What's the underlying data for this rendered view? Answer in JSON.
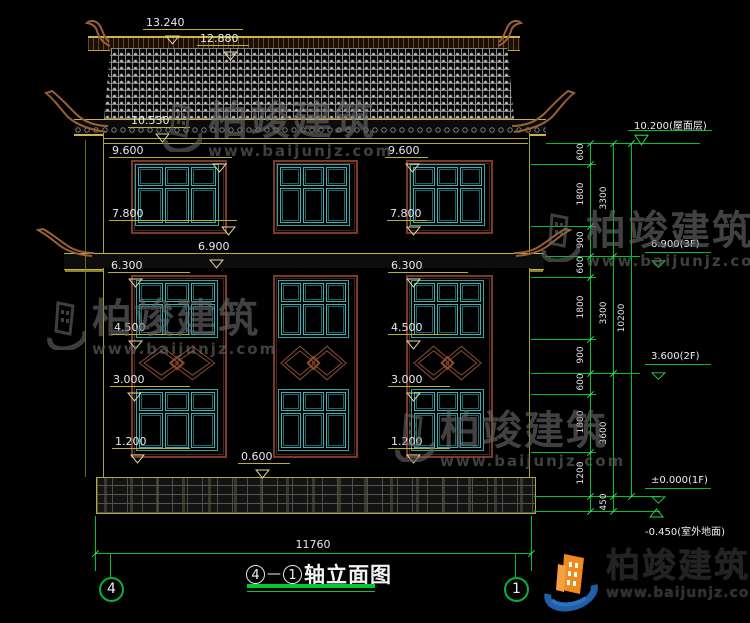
{
  "colors": {
    "green": "#00c032",
    "tick": "#38e860",
    "yellow": "#b8b032",
    "teal": "#2fa5a5",
    "brown": "#7a3a28",
    "white": "#e9e9e9"
  },
  "title": {
    "axis_start": "4",
    "dash": "—",
    "axis_end": "1",
    "label": "轴立面图"
  },
  "axis_bubbles": {
    "left": "4",
    "right": "1"
  },
  "bottom_dimension": {
    "total": "11760"
  },
  "watermark": {
    "brand": "柏竣建筑",
    "url": "www.baijunjz.com"
  },
  "logo": {
    "brand": "柏竣建筑",
    "url": "www.baijunjz.com"
  },
  "left_markers": [
    {
      "t": "13.240",
      "x": 143,
      "y": 16,
      "lw": 100,
      "tx": 22
    },
    {
      "t": "12.880",
      "x": 197,
      "y": 32,
      "lw": 52,
      "tx": 26
    },
    {
      "t": "10.530",
      "x": 128,
      "y": 114,
      "lw": 62,
      "tx": 27
    },
    {
      "t": "9.600",
      "x": 109,
      "y": 144,
      "lw": 123,
      "tx": 103
    },
    {
      "t": "9.600",
      "x": 385,
      "y": 144,
      "lw": 43,
      "tx": 20
    },
    {
      "t": "7.800",
      "x": 109,
      "y": 207,
      "lw": 128,
      "tx": 112
    },
    {
      "t": "7.800",
      "x": 387,
      "y": 207,
      "lw": 40,
      "tx": 19
    },
    {
      "t": "6.900",
      "x": 195,
      "y": 240,
      "lw": 36,
      "tx": 14
    },
    {
      "t": "6.300",
      "x": 108,
      "y": 259,
      "lw": 82,
      "tx": 20
    },
    {
      "t": "6.300",
      "x": 388,
      "y": 259,
      "lw": 80,
      "tx": 18
    },
    {
      "t": "4.500",
      "x": 111,
      "y": 321,
      "lw": 79,
      "tx": 17
    },
    {
      "t": "4.500",
      "x": 388,
      "y": 321,
      "lw": 62,
      "tx": 18
    },
    {
      "t": "3.000",
      "x": 110,
      "y": 373,
      "lw": 80,
      "tx": 17
    },
    {
      "t": "3.000",
      "x": 388,
      "y": 373,
      "lw": 62,
      "tx": 18
    },
    {
      "t": "1.200",
      "x": 112,
      "y": 435,
      "lw": 78,
      "tx": 18
    },
    {
      "t": "1.200",
      "x": 388,
      "y": 435,
      "lw": 62,
      "tx": 18
    },
    {
      "t": "0.600",
      "x": 238,
      "y": 450,
      "lw": 52,
      "tx": 17
    }
  ],
  "right_markers": [
    {
      "t": "10.200(屋面层)",
      "x": 628,
      "y": 117,
      "lw": 84,
      "apex_y": 143,
      "below": false
    },
    {
      "t": "6.900(3F)",
      "x": 645,
      "y": 239,
      "lw": 66,
      "apex_y": 256,
      "below": false
    },
    {
      "t": "3.600(2F)",
      "x": 645,
      "y": 351,
      "lw": 66,
      "apex_y": 373,
      "below": false
    },
    {
      "t": "±0.000(1F)",
      "x": 645,
      "y": 475,
      "lw": 66,
      "apex_y": 496,
      "below": false
    },
    {
      "t": "-0.450(室外地面)",
      "x": 643,
      "y": 519,
      "lw": 66,
      "apex_y": 511,
      "below": true
    }
  ],
  "chain_values": [
    {
      "t": "600",
      "x": 581,
      "y": 153
    },
    {
      "t": "1800",
      "x": 581,
      "y": 195
    },
    {
      "t": "900",
      "x": 581,
      "y": 241
    },
    {
      "t": "600",
      "x": 581,
      "y": 266
    },
    {
      "t": "1800",
      "x": 581,
      "y": 308
    },
    {
      "t": "900",
      "x": 581,
      "y": 356
    },
    {
      "t": "600",
      "x": 581,
      "y": 383
    },
    {
      "t": "1800",
      "x": 581,
      "y": 423
    },
    {
      "t": "1200",
      "x": 581,
      "y": 474
    },
    {
      "t": "450",
      "x": 604,
      "y": 503
    },
    {
      "t": "3300",
      "x": 604,
      "y": 199
    },
    {
      "t": "3300",
      "x": 604,
      "y": 314
    },
    {
      "t": "3600",
      "x": 604,
      "y": 434
    },
    {
      "t": "10200",
      "x": 622,
      "y": 319
    }
  ]
}
